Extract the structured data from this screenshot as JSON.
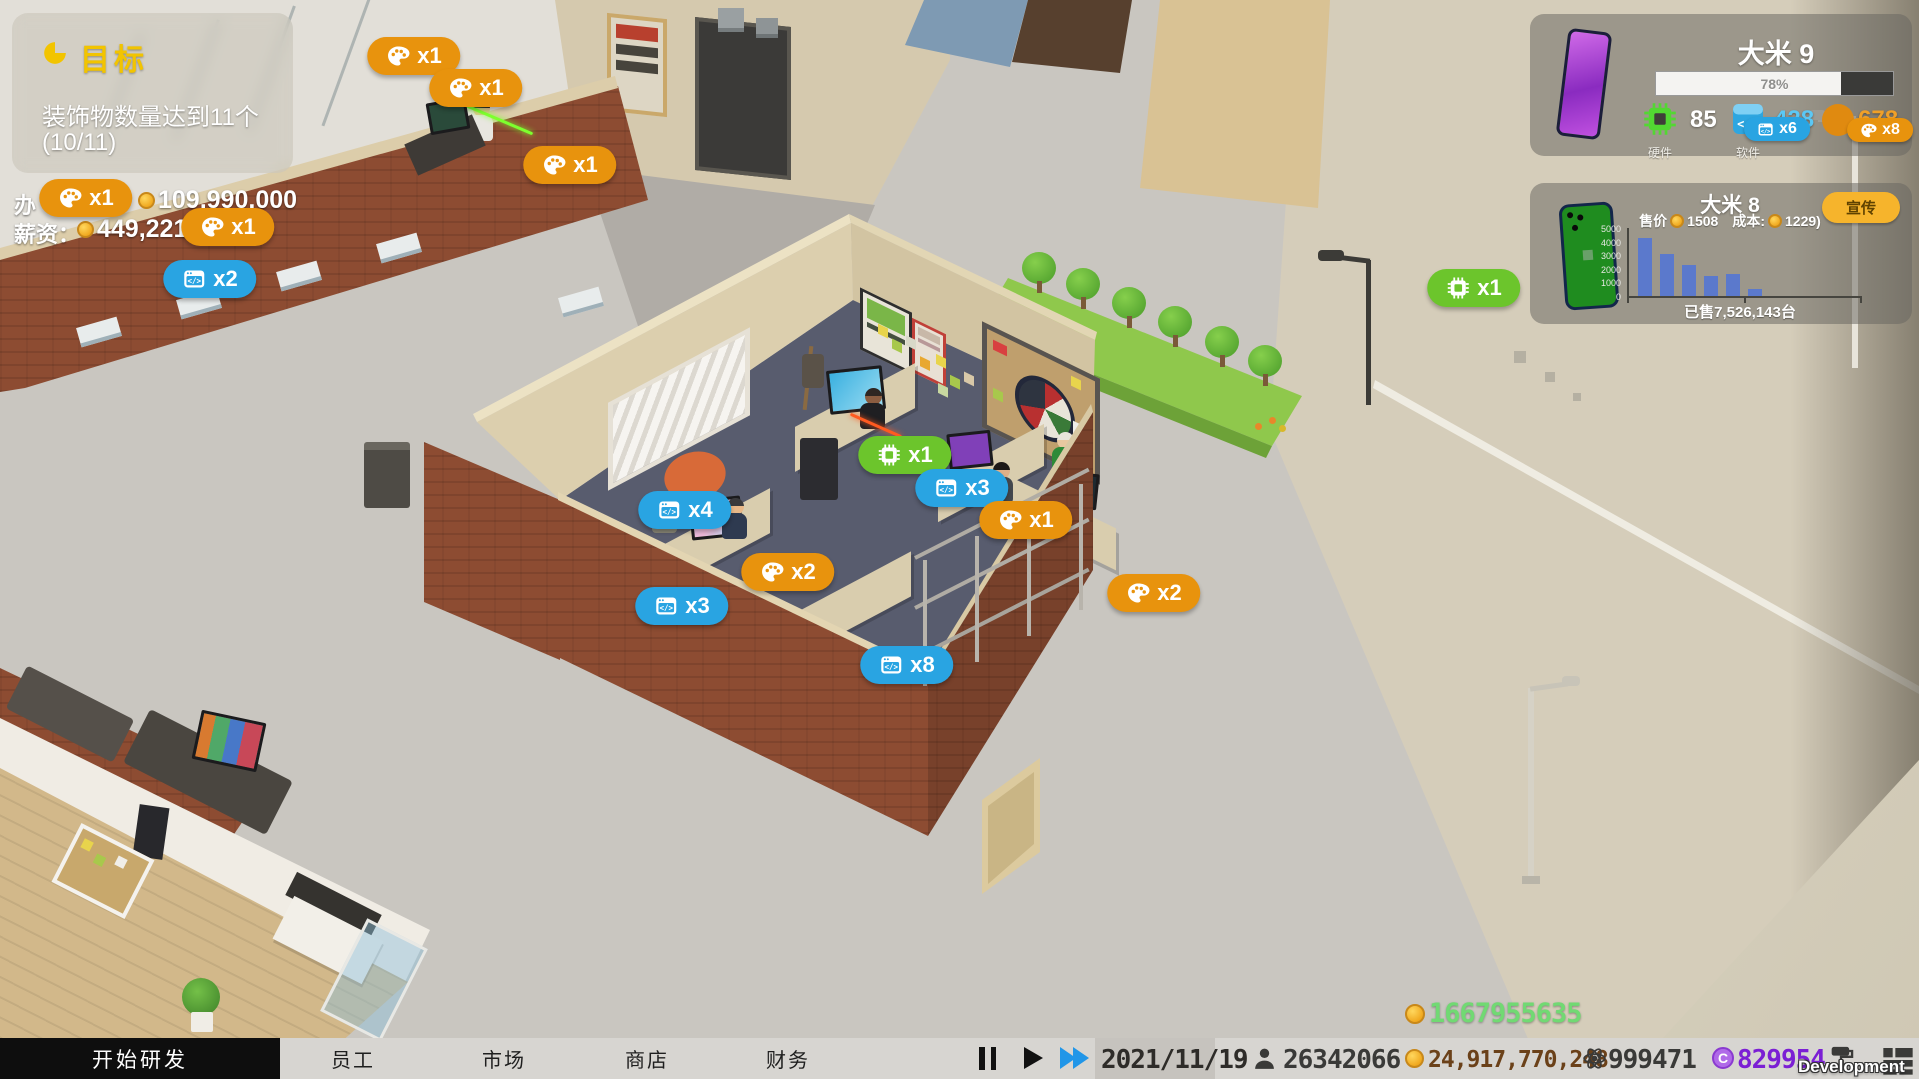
{
  "goal_panel": {
    "title": "目标",
    "description": "装饰物数量达到11个",
    "progress": "(10/11)"
  },
  "hud_left": {
    "line1_prefix": "办",
    "line1_amount": "109,990,000",
    "line2_label": "薪资：",
    "line2_amount": "449,221"
  },
  "dev_panel": {
    "title": "大米 9",
    "progress_label": "78%",
    "progress_pct": 78,
    "stats": [
      {
        "icon": "chip-icon",
        "value": "85",
        "label": "硬件"
      },
      {
        "icon": "code-icon",
        "value": "428",
        "label": "软件"
      },
      {
        "icon": "palette-icon",
        "value": "678",
        "label": ""
      }
    ],
    "badges": [
      {
        "type": "code",
        "label": "x6",
        "x": 247,
        "y": 115
      },
      {
        "type": "palette",
        "label": "x8",
        "x": 350,
        "y": 116
      }
    ]
  },
  "sales_panel": {
    "title": "大米 8",
    "price_label": "售价",
    "price": "1508",
    "cost_label": "成本:",
    "cost": "1229)",
    "promote": "宣传",
    "sold": "已售7,526,143台",
    "chart_data": {
      "type": "bar",
      "categories": [
        "1",
        "2",
        "3",
        "4",
        "5",
        "6"
      ],
      "values": [
        4250,
        3100,
        2250,
        1450,
        1600,
        480
      ],
      "ylim": [
        0,
        5000
      ],
      "yticks": [
        0,
        1000,
        2000,
        3000,
        4000,
        5000
      ],
      "bar_color": "#5b79cc",
      "title": "大米 8 周销量",
      "xlabel": "",
      "ylabel": ""
    }
  },
  "world_badges": [
    {
      "type": "palette",
      "label": "x1",
      "x": 414,
      "y": 56
    },
    {
      "type": "palette",
      "label": "x1",
      "x": 476,
      "y": 88
    },
    {
      "type": "palette",
      "label": "x1",
      "x": 570,
      "y": 165
    },
    {
      "type": "palette",
      "label": "x1",
      "x": 86,
      "y": 198
    },
    {
      "type": "palette",
      "label": "x1",
      "x": 228,
      "y": 227
    },
    {
      "type": "code",
      "label": "x2",
      "x": 210,
      "y": 279
    },
    {
      "type": "chip",
      "label": "x1",
      "x": 1474,
      "y": 288
    },
    {
      "type": "chip",
      "label": "x1",
      "x": 905,
      "y": 455
    },
    {
      "type": "code",
      "label": "x3",
      "x": 962,
      "y": 488
    },
    {
      "type": "palette",
      "label": "x1",
      "x": 1026,
      "y": 520
    },
    {
      "type": "code",
      "label": "x4",
      "x": 685,
      "y": 510
    },
    {
      "type": "palette",
      "label": "x2",
      "x": 788,
      "y": 572
    },
    {
      "type": "code",
      "label": "x3",
      "x": 682,
      "y": 606
    },
    {
      "type": "palette",
      "label": "x2",
      "x": 1154,
      "y": 593
    },
    {
      "type": "code",
      "label": "x8",
      "x": 907,
      "y": 665
    }
  ],
  "floating_money": {
    "value": "1667955635"
  },
  "bottom_bar": {
    "primary_tab": "开始研发",
    "tabs": [
      "员工",
      "市场",
      "商店",
      "财务"
    ],
    "date": "2021/11/19",
    "population": "26342066",
    "money": "24,917,770,248",
    "science": "999471",
    "c_currency": "829954"
  },
  "watermark": "Development Build",
  "colors": {
    "badge_orange": "#e8930d",
    "badge_blue": "#29a4e2",
    "badge_green": "#6cc52c",
    "accent_yellow": "#f2c400",
    "money_green": "#71d973",
    "money_brown": "#6b4119",
    "purple_currency": "#7b1fd4",
    "bar_blue": "#5b79cc"
  }
}
